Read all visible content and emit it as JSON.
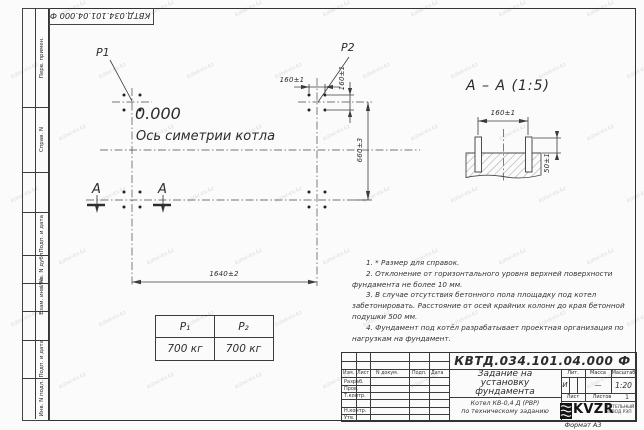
{
  "watermark": {
    "text": "kotel-kv.kz"
  },
  "frame": {
    "corner_stamp": "КВТД.034.101.04.000 Ф",
    "format_label": "Формат А3",
    "side_labels": {
      "perv": "Перв. примен.",
      "sprav": "Справ. N",
      "podp1": "Подп. и дата",
      "inv_dubl": "Инв. N дубл.",
      "vzam": "Взам. инв. N",
      "podp2": "Подп. и дата",
      "inv_podl": "Инв. N подл."
    }
  },
  "plan": {
    "p1": "P1",
    "p2": "P2",
    "level": "0.000",
    "axis_label": "Ось симетрии котла",
    "dim_bolt_h": "160±1",
    "dim_bolt_v": "160±1",
    "dim_rows": "660±3",
    "dim_cols": "1640±2",
    "section_mark_left": "А",
    "section_mark_right": "А"
  },
  "section": {
    "title": "А – А (1:5)",
    "dim_width": "160±1",
    "dim_height": "50±1"
  },
  "load_table": {
    "col1_header": "P₁",
    "col2_header": "P₂",
    "col1_value": "700 кг",
    "col2_value": "700 кг"
  },
  "notes": {
    "n1": "1. * Размер для справок.",
    "n2": "2. Отклонение от горизонтального уровня верхней поверхности фундамента не более 10 мм.",
    "n3": "3. В случае отсутствия бетонного пола площадку под котел забетонировать. Расстояние от осей крайних колонн до края бетонной подушки 500 мм.",
    "n4": "4. Фундамент под котёл разрабатывает проектная организация по нагрузкам на фундамент."
  },
  "title_block": {
    "doc_number": "КВТД.034.101.04.000 Ф",
    "title_l1": "Задание на",
    "title_l2": "установку",
    "title_l3": "фундамента",
    "product_l1": "Котел КВ-0,4 Д (РВР)",
    "product_l2": "по техническому заданию",
    "col_izm": "Изм.",
    "col_list": "Лист",
    "col_doc": "N докум.",
    "col_podp": "Подп.",
    "col_data": "Дата",
    "row_razrab": "Разраб.",
    "row_prov": "Пров.",
    "row_tkontr": "Т.контр.",
    "row_nkontr": "Н.контр.",
    "row_utv": "Утв.",
    "lit_label": "Лит.",
    "mass_label": "Масса",
    "scale_label": "Масштаб",
    "lit_value": "И",
    "mass_value": "—",
    "scale_value": "1:20",
    "sheet_label": "Лист",
    "sheets_label": "Листов",
    "sheets_value": "1",
    "brand": "KVZR",
    "brand_sub_l1": "КОТЕЛЬНЫЙ",
    "brand_sub_l2": "ЗАВОД РЭП"
  }
}
